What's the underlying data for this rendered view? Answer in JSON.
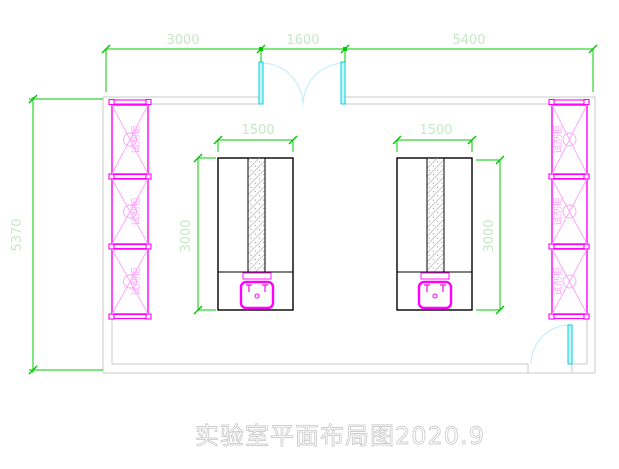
{
  "title": "实验室平面布局图2020.9",
  "cabinet_label": "试剂柜",
  "dims": {
    "top_left": "3000",
    "top_middle": "1600",
    "top_right": "5400",
    "room_height": "5370",
    "bench_width": "1500",
    "bench_length": "3000"
  },
  "colors": {
    "dimension": "#00c800",
    "dimension_text": "#c4e9c4",
    "cabinet": "#ff00ff",
    "cabinet_light": "#ff9fff",
    "door": "#00d2dc",
    "door_fill": "#c8f6f8",
    "door_arc": "#bceef3",
    "wall": "#c9c9c9",
    "bench": "#000000",
    "title": "#cfcfcf"
  }
}
